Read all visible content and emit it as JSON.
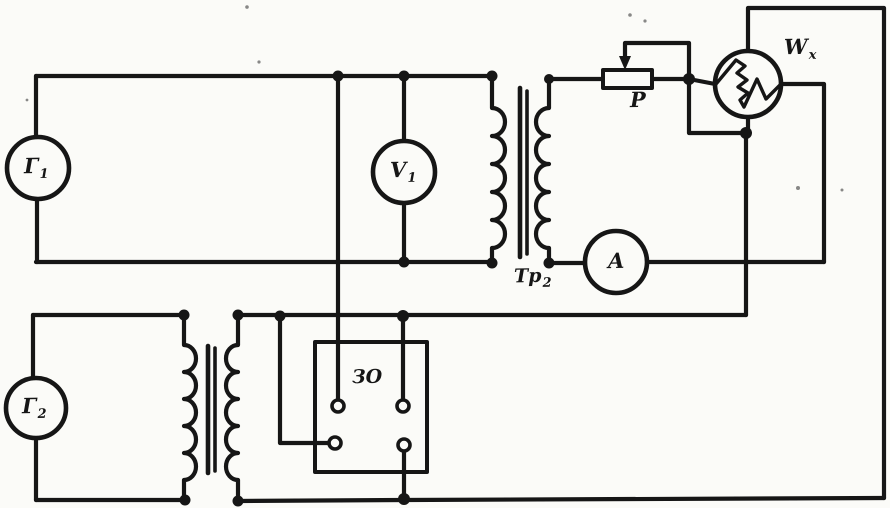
{
  "figure": {
    "kind": "hand-drawn circuit schematic (scanned)",
    "colors": {
      "ink": "#161616",
      "background": "#fbfbf8"
    },
    "labels": {
      "generator1": {
        "base": "Г",
        "sub": "1"
      },
      "generator2": {
        "base": "Г",
        "sub": "2"
      },
      "voltmeter": {
        "base": "V",
        "sub": "1"
      },
      "ammeter": {
        "base": "A",
        "sub": ""
      },
      "bolometer": {
        "base": "W",
        "sub": "x"
      },
      "rheostat": {
        "base": "P",
        "sub": ""
      },
      "transformer2": {
        "base": "Тр",
        "sub": "2"
      },
      "oscillograph": {
        "base": "ЗО",
        "sub": ""
      }
    }
  }
}
